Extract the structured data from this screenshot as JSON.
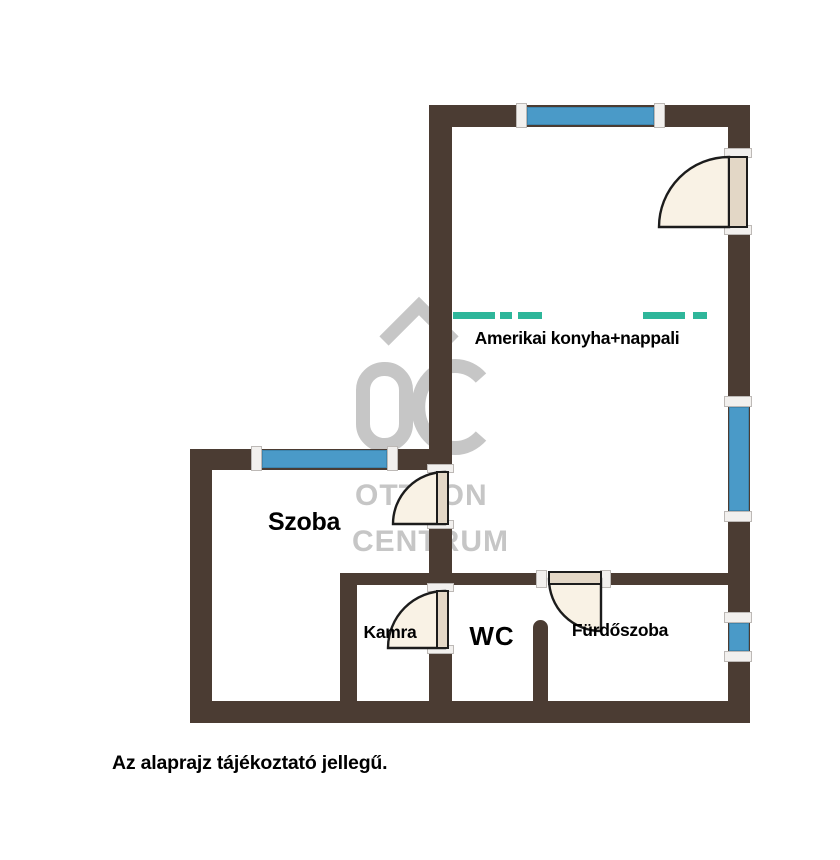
{
  "floorplan": {
    "rooms": [
      {
        "name": "living-kitchen",
        "label": "Amerikai konyha+nappali"
      },
      {
        "name": "room",
        "label": "Szoba"
      },
      {
        "name": "pantry",
        "label": "Kamra"
      },
      {
        "name": "wc",
        "label": "WC"
      },
      {
        "name": "bathroom",
        "label": "Fürdőszoba"
      }
    ],
    "note": "Az alaprajz tájékoztató jellegű.",
    "watermark": {
      "logo_text": "OC",
      "line1": "OTTHON",
      "line2": "CENTRUM"
    },
    "colors": {
      "wall": "#4b3c33",
      "window": "#4a9ac8",
      "window_edge": "#3d85ae",
      "kitchen_divider": "#2eb69a",
      "door_fill": "#f9f2e5",
      "door_leaf": "#e3d7c6",
      "door_stroke": "#1c1c1c",
      "jamb": "#f2f0ee",
      "jamb_border": "#bdb9b6",
      "watermark": "#c6c6c6",
      "label": "#000000",
      "background": "#ffffff"
    }
  }
}
